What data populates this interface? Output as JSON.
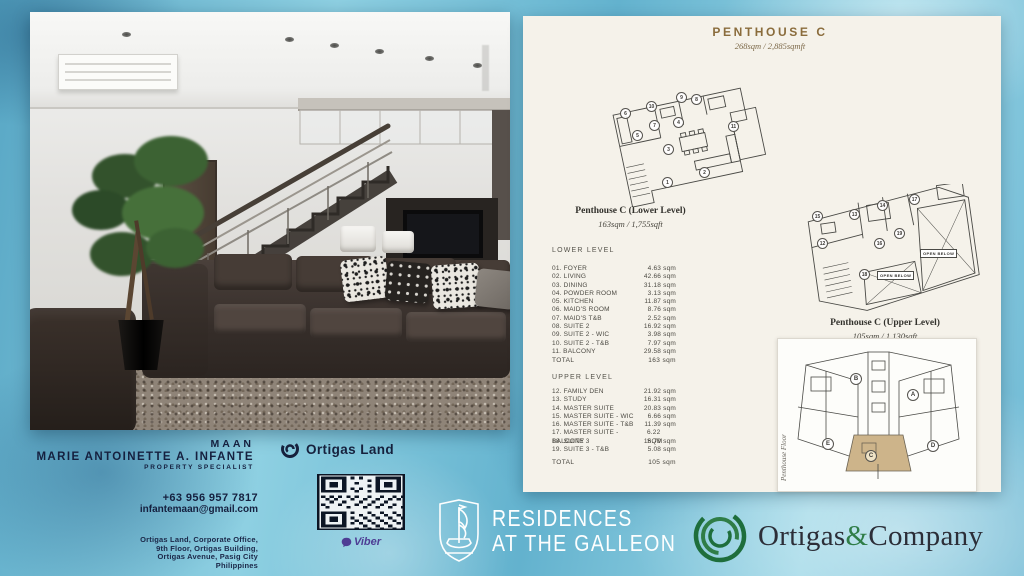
{
  "title": {
    "text": "PENTHOUSE C",
    "subtitle": "268sqm / 2,885sqmft"
  },
  "lower_level": {
    "heading": "Penthouse C (Lower Level)",
    "subheading": "163sqm / 1,755sqft",
    "section_label": "LOWER LEVEL",
    "rows": [
      {
        "label": "01. FOYER",
        "value": "4.63 sqm"
      },
      {
        "label": "02. LIVING",
        "value": "42.66 sqm"
      },
      {
        "label": "03. DINING",
        "value": "31.18 sqm"
      },
      {
        "label": "04. POWDER ROOM",
        "value": "3.13 sqm"
      },
      {
        "label": "05. KITCHEN",
        "value": "11.87 sqm"
      },
      {
        "label": "06. MAID'S ROOM",
        "value": "8.76 sqm"
      },
      {
        "label": "07. MAID'S T&B",
        "value": "2.52 sqm"
      },
      {
        "label": "08. SUITE 2",
        "value": "16.92 sqm"
      },
      {
        "label": "09. SUITE 2 - WIC",
        "value": "3.98 sqm"
      },
      {
        "label": "10. SUITE 2 - T&B",
        "value": "7.97 sqm"
      },
      {
        "label": "11. BALCONY",
        "value": "29.58 sqm"
      }
    ],
    "total_label": "TOTAL",
    "total_value": "163 sqm",
    "markers": [
      {
        "n": "1",
        "x": 70,
        "y": 102
      },
      {
        "n": "2",
        "x": 107,
        "y": 92
      },
      {
        "n": "3",
        "x": 71,
        "y": 69
      },
      {
        "n": "4",
        "x": 81,
        "y": 42
      },
      {
        "n": "5",
        "x": 40,
        "y": 55
      },
      {
        "n": "6",
        "x": 28,
        "y": 33
      },
      {
        "n": "7",
        "x": 57,
        "y": 45
      },
      {
        "n": "8",
        "x": 99,
        "y": 19
      },
      {
        "n": "9",
        "x": 84,
        "y": 17
      },
      {
        "n": "10",
        "x": 54,
        "y": 26
      },
      {
        "n": "11",
        "x": 136,
        "y": 46
      }
    ]
  },
  "upper_level": {
    "heading": "Penthouse C (Upper Level)",
    "subheading": "105sqm / 1,130sqft",
    "section_label": "UPPER  LEVEL",
    "open_below_label": "OPEN BELOW",
    "rows": [
      {
        "label": "12. FAMILY DEN",
        "value": "21.92 sqm"
      },
      {
        "label": "13. STUDY",
        "value": "16.31 sqm"
      },
      {
        "label": "14. MASTER SUITE",
        "value": "20.83 sqm"
      },
      {
        "label": "15. MASTER SUITE - WIC",
        "value": "6.66 sqm"
      },
      {
        "label": "16. MASTER SUITE - T&B",
        "value": "11.39 sqm"
      },
      {
        "label": "17. MASTER SUITE - BALCONY",
        "value": "6.22 SQM"
      },
      {
        "label": "18. SUITE 3",
        "value": "16.79 sqm"
      },
      {
        "label": "19. SUITE 3 - T&B",
        "value": "5.08 sqm"
      }
    ],
    "total_label": "TOTAL",
    "total_value": "105 sqm",
    "markers": [
      {
        "n": "12",
        "x": 22,
        "y": 54
      },
      {
        "n": "13",
        "x": 54,
        "y": 25
      },
      {
        "n": "14",
        "x": 82,
        "y": 16
      },
      {
        "n": "15",
        "x": 17,
        "y": 27
      },
      {
        "n": "16",
        "x": 79,
        "y": 54
      },
      {
        "n": "17",
        "x": 114,
        "y": 10
      },
      {
        "n": "18",
        "x": 64,
        "y": 85
      },
      {
        "n": "19",
        "x": 99,
        "y": 44
      }
    ]
  },
  "keyplan": {
    "side_label": "Penthouse Floor",
    "units": [
      {
        "label": "A",
        "x": 129,
        "y": 50
      },
      {
        "label": "B",
        "x": 72,
        "y": 34
      },
      {
        "label": "C",
        "x": 87,
        "y": 111,
        "hl": true
      },
      {
        "label": "D",
        "x": 149,
        "y": 101
      },
      {
        "label": "E",
        "x": 44,
        "y": 99
      }
    ]
  },
  "agent": {
    "nickname": "MAAN",
    "name": "MARIE ANTOINETTE A. INFANTE",
    "role": "PROPERTY SPECIALIST",
    "phone": "+63 956 957 7817",
    "email": "infantemaan@gmail.com",
    "address_lines": [
      "Ortigas Land, Corporate Office,",
      "9th Floor, Ortigas Building,",
      "Ortigas Avenue, Pasig City",
      "Philippines"
    ]
  },
  "brands": {
    "ortigas_land": "Ortigas Land",
    "viber": "Viber",
    "residences_line1": "RESIDENCES",
    "residences_line2": "AT THE GALLEON",
    "company_pre": "Ortigas",
    "company_amp": "&",
    "company_post": "Company"
  },
  "colors": {
    "title_brown": "#8a6c3c",
    "navy": "#15203f",
    "viber_purple": "#4e3d94",
    "company_green": "#2f7d47",
    "unit_highlight": "#cdb48a",
    "panel_cream": "#f5f2ea"
  }
}
